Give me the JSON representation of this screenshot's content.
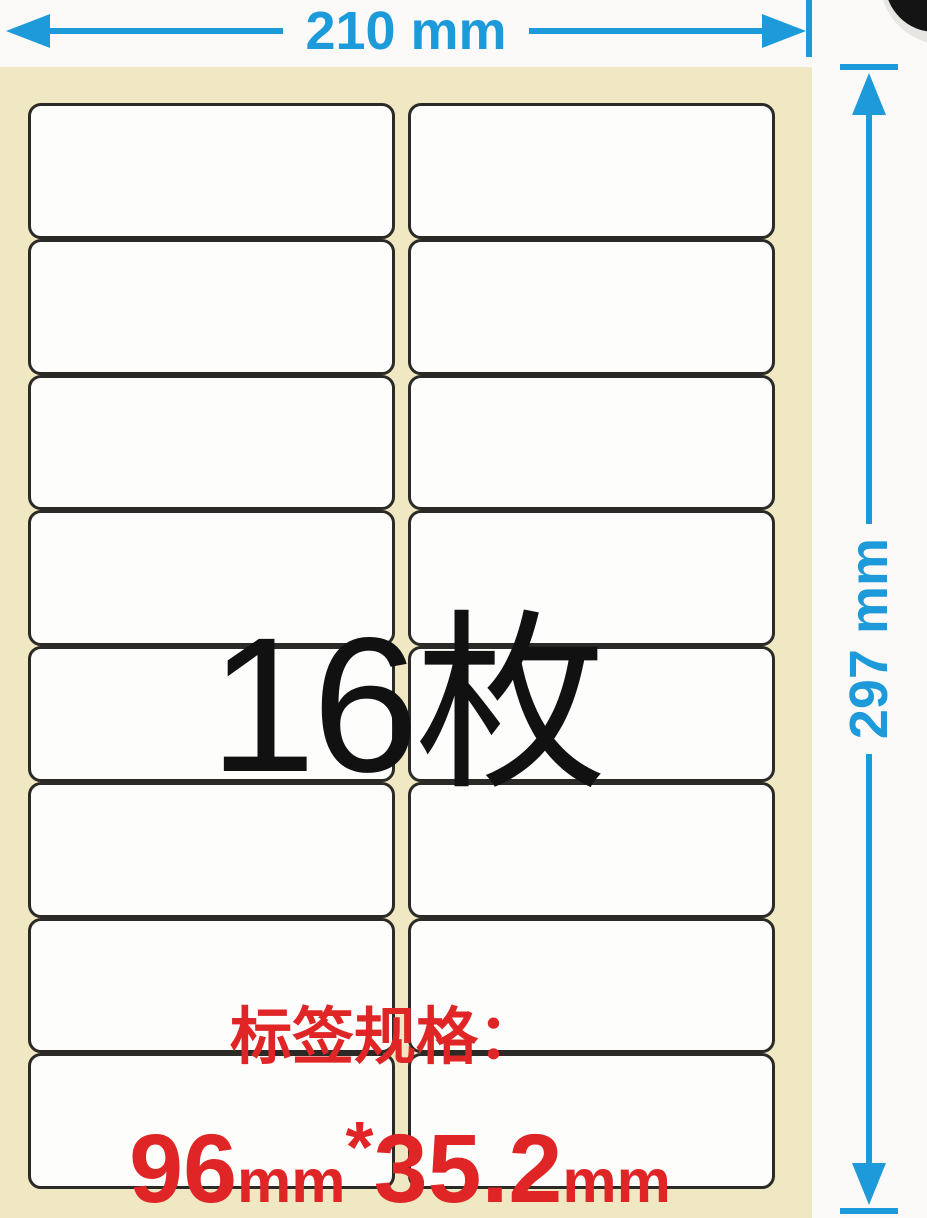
{
  "horizontal_dimension": {
    "label": "210 mm"
  },
  "vertical_dimension": {
    "label": "297 mm"
  },
  "sheet": {
    "rows": 8,
    "columns": 2,
    "label_count_text": "16枚",
    "spec_caption": "标签规格：",
    "spec_value": {
      "width_number": "96",
      "width_unit": "mm",
      "separator": "*",
      "height_number": "35.2",
      "height_unit": "mm"
    }
  },
  "colors": {
    "accent_blue": "#1c9ad9",
    "accent_red": "#e02526",
    "sheet_bg": "#efe8c3",
    "label_fill": "#fdfdfc",
    "label_border": "#2b2a26",
    "count_color": "#111111",
    "page_bg": "#fbfaf8"
  }
}
